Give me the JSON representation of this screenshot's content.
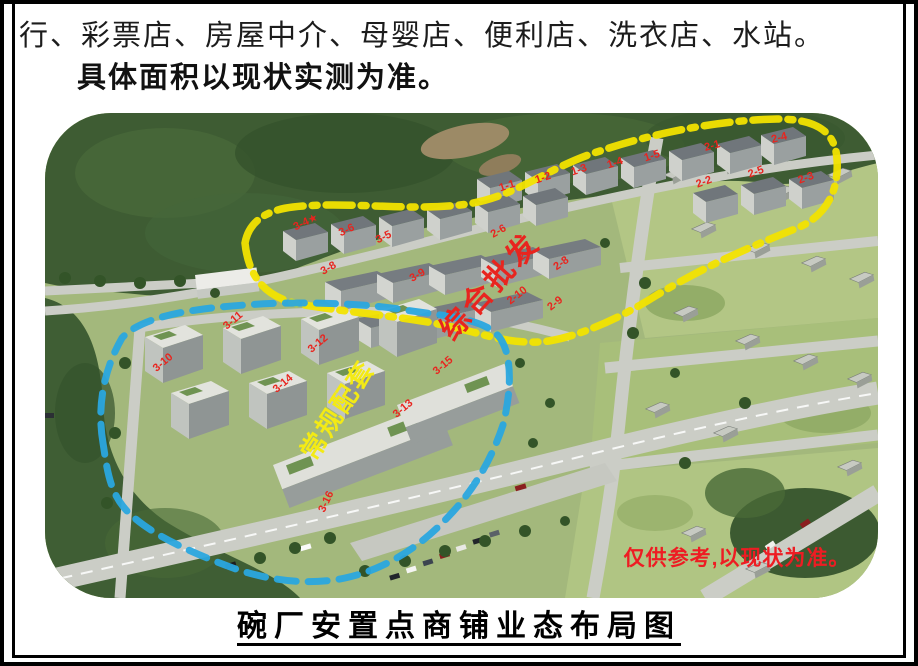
{
  "document": {
    "line1": "行、彩票店、房屋中介、母婴店、便利店、洗衣店、水站。",
    "line2": "具体面积以现状实测为准。",
    "caption": "碗厂安置点商铺业态布局图"
  },
  "photo": {
    "zones": [
      {
        "name": "综合批发",
        "outline_color": "#f2e300",
        "outline_style": "dash-dot",
        "label_color": "#e8251f"
      },
      {
        "name": "常规配套",
        "outline_color": "#2aa7df",
        "outline_style": "dashed",
        "label_color": "#f3ea15"
      }
    ],
    "disclaimer": "仅供参考,以现状为准。",
    "disclaimer_color": "#ee1c23",
    "building_label_color": "#e8251f",
    "building_labels": [
      {
        "t": "1-1",
        "x": 463,
        "y": 76,
        "r": -18
      },
      {
        "t": "1-2",
        "x": 499,
        "y": 68,
        "r": -18
      },
      {
        "t": "1-3",
        "x": 535,
        "y": 60,
        "r": -18
      },
      {
        "t": "1-4",
        "x": 571,
        "y": 53,
        "r": -18
      },
      {
        "t": "1-5",
        "x": 608,
        "y": 46,
        "r": -18
      },
      {
        "t": "2-1",
        "x": 668,
        "y": 36,
        "r": -15
      },
      {
        "t": "2-4",
        "x": 735,
        "y": 28,
        "r": -15
      },
      {
        "t": "2-2",
        "x": 660,
        "y": 72,
        "r": -20
      },
      {
        "t": "2-5",
        "x": 712,
        "y": 62,
        "r": -20
      },
      {
        "t": "2-3",
        "x": 762,
        "y": 68,
        "r": -20
      },
      {
        "t": "3-4★",
        "x": 262,
        "y": 112,
        "r": -25
      },
      {
        "t": "3-6",
        "x": 303,
        "y": 120,
        "r": -25
      },
      {
        "t": "3-5",
        "x": 340,
        "y": 127,
        "r": -25
      },
      {
        "t": "3-8",
        "x": 285,
        "y": 158,
        "r": -30
      },
      {
        "t": "3-9",
        "x": 374,
        "y": 165,
        "r": -30
      },
      {
        "t": "2-6",
        "x": 455,
        "y": 121,
        "r": -30
      },
      {
        "t": "2-7",
        "x": 483,
        "y": 143,
        "r": -35
      },
      {
        "t": "2-8",
        "x": 518,
        "y": 153,
        "r": -35
      },
      {
        "t": "2-10",
        "x": 474,
        "y": 185,
        "r": -38
      },
      {
        "t": "2-9",
        "x": 512,
        "y": 193,
        "r": -38
      },
      {
        "t": "3-11",
        "x": 190,
        "y": 210,
        "r": -40
      },
      {
        "t": "3-12",
        "x": 275,
        "y": 233,
        "r": -40
      },
      {
        "t": "3-15",
        "x": 400,
        "y": 255,
        "r": -40
      },
      {
        "t": "3-10",
        "x": 120,
        "y": 252,
        "r": -40
      },
      {
        "t": "3-14",
        "x": 240,
        "y": 273,
        "r": -40
      },
      {
        "t": "3-13",
        "x": 360,
        "y": 298,
        "r": -40
      },
      {
        "t": "3-16",
        "x": 284,
        "y": 390,
        "r": -65
      }
    ]
  }
}
